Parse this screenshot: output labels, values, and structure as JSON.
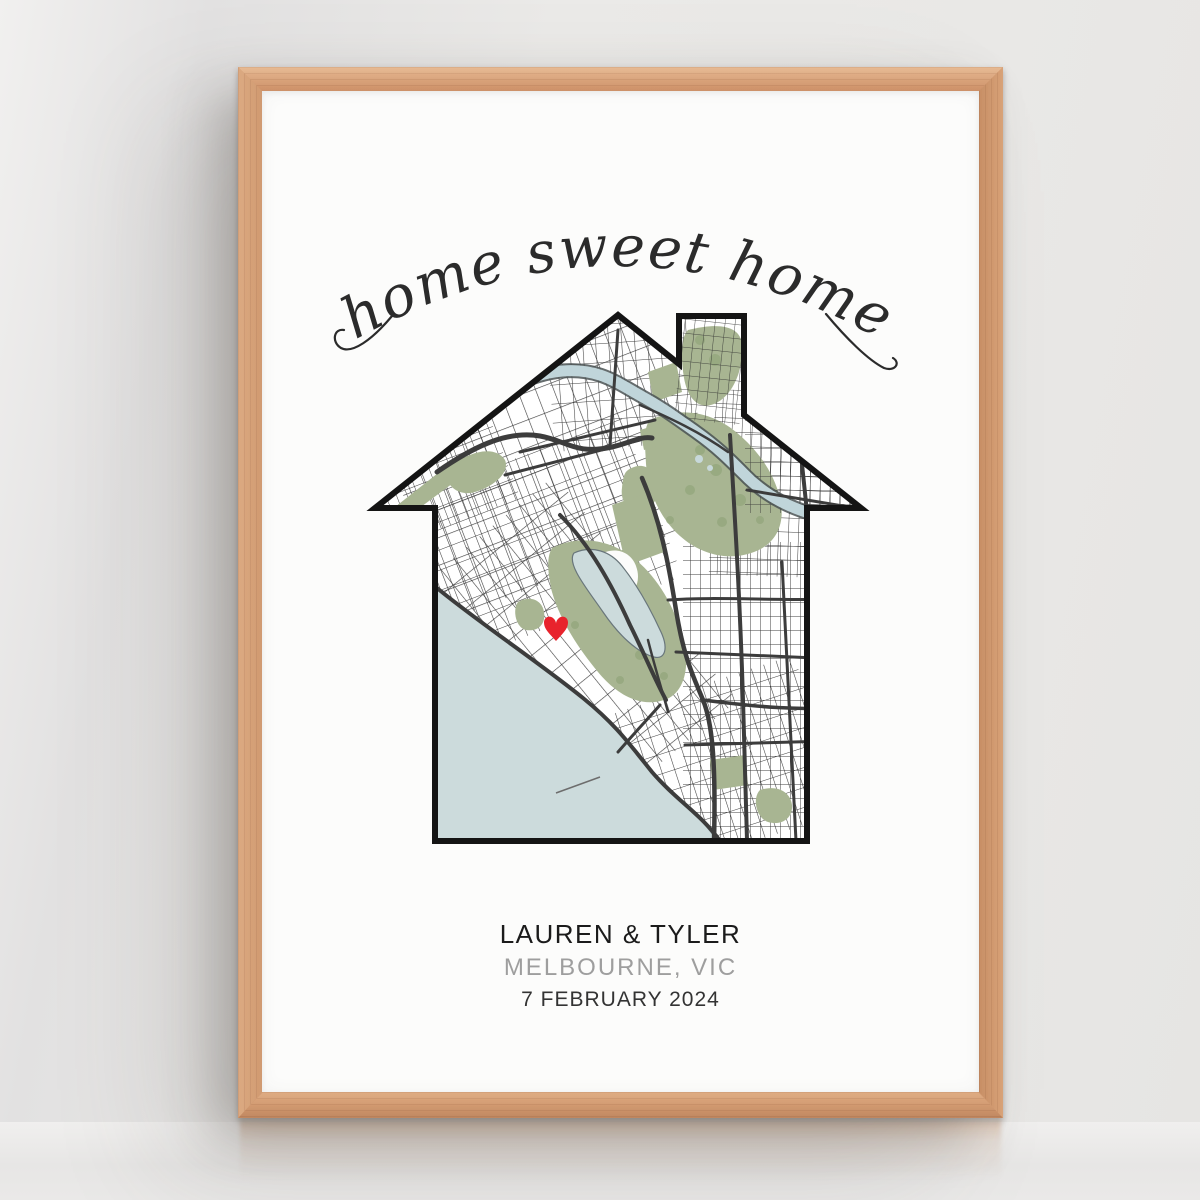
{
  "poster": {
    "script_title": "home sweet home",
    "caption": {
      "names": "LAUREN & TYLER",
      "location": "MELBOURNE, VIC",
      "date": "7 FEBRUARY 2024"
    }
  },
  "marker": {
    "name": "heart-marker",
    "color": "#e8232c"
  },
  "colors": {
    "script_ink": "#2b2b2b",
    "outline": "#141414",
    "road_major": "#3c3c3c",
    "road_minor": "#2d2d2d",
    "river_casing": "#4a5253",
    "park": "#a8b592",
    "tree": "#8ba174",
    "river": "#c0d5da",
    "water": "#ccdbdc",
    "water_edge": "#75838a",
    "pond": "#c7d8da",
    "pier": "#6d6d6d",
    "names_text": "#1b1b1b",
    "location_text": "#9e9e9e",
    "date_text": "#333333",
    "frame_wood": "#d39c73",
    "poster_bg": "#fcfcfb",
    "wall": "#e9e8e6"
  }
}
